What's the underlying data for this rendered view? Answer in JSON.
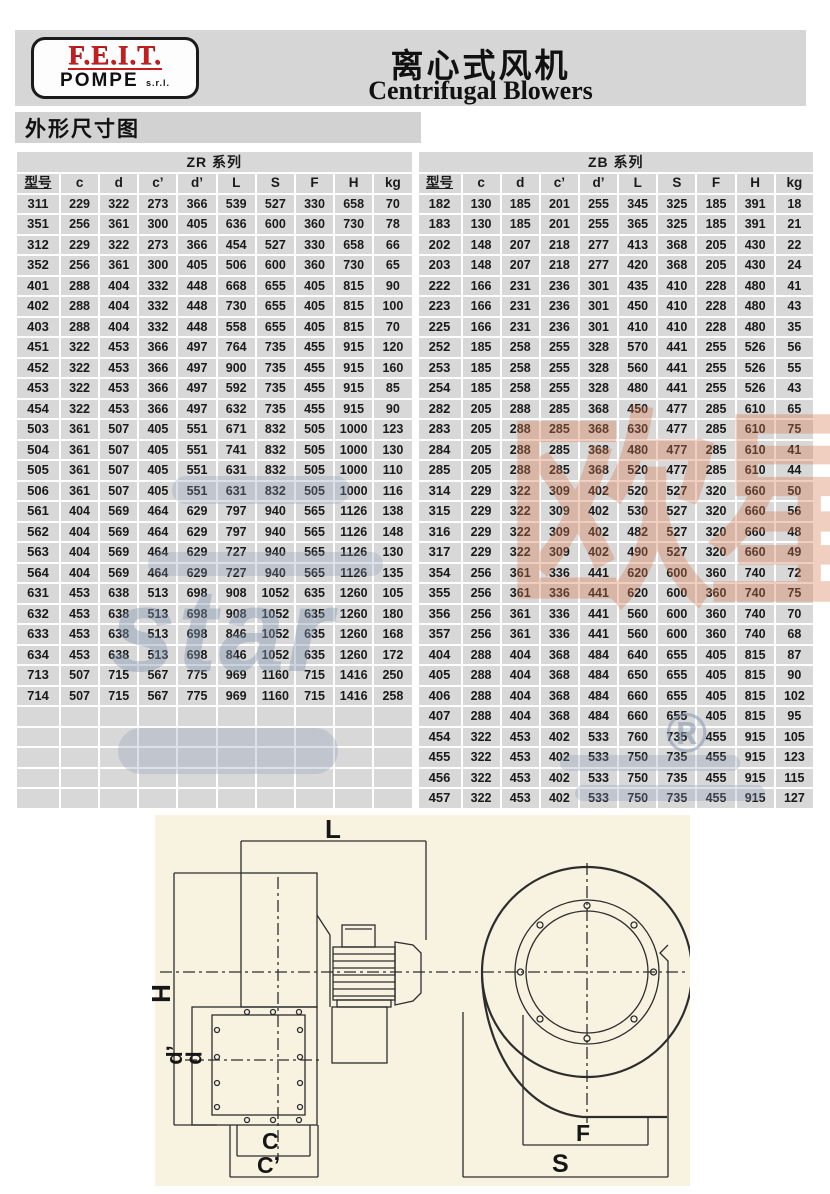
{
  "header": {
    "logo_line1": "F.E.I.T.",
    "logo_line2": "POMPE",
    "logo_suffix": "s.r.l.",
    "title_zh": "离心式风机",
    "title_en": "Centrifugal Blowers"
  },
  "section_label": "外形尺寸图",
  "tables": [
    {
      "title": "ZR 系列",
      "columns": [
        "型号",
        "c",
        "d",
        "c’",
        "d’",
        "L",
        "S",
        "F",
        "H",
        "kg"
      ],
      "rows": [
        [
          "311",
          229,
          322,
          273,
          366,
          539,
          527,
          330,
          658,
          70
        ],
        [
          "351",
          256,
          361,
          300,
          405,
          636,
          600,
          360,
          730,
          78
        ],
        [
          "312",
          229,
          322,
          273,
          366,
          454,
          527,
          330,
          658,
          66
        ],
        [
          "352",
          256,
          361,
          300,
          405,
          506,
          600,
          360,
          730,
          65
        ],
        [
          "401",
          288,
          404,
          332,
          448,
          668,
          655,
          405,
          815,
          90
        ],
        [
          "402",
          288,
          404,
          332,
          448,
          730,
          655,
          405,
          815,
          100
        ],
        [
          "403",
          288,
          404,
          332,
          448,
          558,
          655,
          405,
          815,
          70
        ],
        [
          "451",
          322,
          453,
          366,
          497,
          764,
          735,
          455,
          915,
          120
        ],
        [
          "452",
          322,
          453,
          366,
          497,
          900,
          735,
          455,
          915,
          160
        ],
        [
          "453",
          322,
          453,
          366,
          497,
          592,
          735,
          455,
          915,
          85
        ],
        [
          "454",
          322,
          453,
          366,
          497,
          632,
          735,
          455,
          915,
          90
        ],
        [
          "503",
          361,
          507,
          405,
          551,
          671,
          832,
          505,
          1000,
          123
        ],
        [
          "504",
          361,
          507,
          405,
          551,
          741,
          832,
          505,
          1000,
          130
        ],
        [
          "505",
          361,
          507,
          405,
          551,
          631,
          832,
          505,
          1000,
          110
        ],
        [
          "506",
          361,
          507,
          405,
          551,
          631,
          832,
          505,
          1000,
          116
        ],
        [
          "561",
          404,
          569,
          464,
          629,
          797,
          940,
          565,
          1126,
          138
        ],
        [
          "562",
          404,
          569,
          464,
          629,
          797,
          940,
          565,
          1126,
          148
        ],
        [
          "563",
          404,
          569,
          464,
          629,
          727,
          940,
          565,
          1126,
          130
        ],
        [
          "564",
          404,
          569,
          464,
          629,
          727,
          940,
          565,
          1126,
          135
        ],
        [
          "631",
          453,
          638,
          513,
          698,
          908,
          1052,
          635,
          1260,
          105
        ],
        [
          "632",
          453,
          638,
          513,
          698,
          908,
          1052,
          635,
          1260,
          180
        ],
        [
          "633",
          453,
          638,
          513,
          698,
          846,
          1052,
          635,
          1260,
          168
        ],
        [
          "634",
          453,
          638,
          513,
          698,
          846,
          1052,
          635,
          1260,
          172
        ],
        [
          "713",
          507,
          715,
          567,
          775,
          969,
          1160,
          715,
          1416,
          250
        ],
        [
          "714",
          507,
          715,
          567,
          775,
          969,
          1160,
          715,
          1416,
          258
        ],
        [
          "",
          "",
          "",
          "",
          "",
          "",
          "",
          "",
          "",
          ""
        ],
        [
          "",
          "",
          "",
          "",
          "",
          "",
          "",
          "",
          "",
          ""
        ],
        [
          "",
          "",
          "",
          "",
          "",
          "",
          "",
          "",
          "",
          ""
        ],
        [
          "",
          "",
          "",
          "",
          "",
          "",
          "",
          "",
          "",
          ""
        ],
        [
          "",
          "",
          "",
          "",
          "",
          "",
          "",
          "",
          "",
          ""
        ]
      ]
    },
    {
      "title": "ZB 系列",
      "columns": [
        "型号",
        "c",
        "d",
        "c’",
        "d’",
        "L",
        "S",
        "F",
        "H",
        "kg"
      ],
      "rows": [
        [
          "182",
          130,
          185,
          201,
          255,
          345,
          325,
          185,
          391,
          18
        ],
        [
          "183",
          130,
          185,
          201,
          255,
          365,
          325,
          185,
          391,
          21
        ],
        [
          "202",
          148,
          207,
          218,
          277,
          413,
          368,
          205,
          430,
          22
        ],
        [
          "203",
          148,
          207,
          218,
          277,
          420,
          368,
          205,
          430,
          24
        ],
        [
          "222",
          166,
          231,
          236,
          301,
          435,
          410,
          228,
          480,
          41
        ],
        [
          "223",
          166,
          231,
          236,
          301,
          450,
          410,
          228,
          480,
          43
        ],
        [
          "225",
          166,
          231,
          236,
          301,
          410,
          410,
          228,
          480,
          35
        ],
        [
          "252",
          185,
          258,
          255,
          328,
          570,
          441,
          255,
          526,
          56
        ],
        [
          "253",
          185,
          258,
          255,
          328,
          560,
          441,
          255,
          526,
          55
        ],
        [
          "254",
          185,
          258,
          255,
          328,
          480,
          441,
          255,
          526,
          43
        ],
        [
          "282",
          205,
          288,
          285,
          368,
          450,
          477,
          285,
          610,
          65
        ],
        [
          "283",
          205,
          288,
          285,
          368,
          630,
          477,
          285,
          610,
          75
        ],
        [
          "284",
          205,
          288,
          285,
          368,
          480,
          477,
          285,
          610,
          41
        ],
        [
          "285",
          205,
          288,
          285,
          368,
          520,
          477,
          285,
          610,
          44
        ],
        [
          "314",
          229,
          322,
          309,
          402,
          520,
          527,
          320,
          660,
          50
        ],
        [
          "315",
          229,
          322,
          309,
          402,
          530,
          527,
          320,
          660,
          56
        ],
        [
          "316",
          229,
          322,
          309,
          402,
          482,
          527,
          320,
          660,
          48
        ],
        [
          "317",
          229,
          322,
          309,
          402,
          490,
          527,
          320,
          660,
          49
        ],
        [
          "354",
          256,
          361,
          336,
          441,
          620,
          600,
          360,
          740,
          72
        ],
        [
          "355",
          256,
          361,
          336,
          441,
          620,
          600,
          360,
          740,
          75
        ],
        [
          "356",
          256,
          361,
          336,
          441,
          560,
          600,
          360,
          740,
          70
        ],
        [
          "357",
          256,
          361,
          336,
          441,
          560,
          600,
          360,
          740,
          68
        ],
        [
          "404",
          288,
          404,
          368,
          484,
          640,
          655,
          405,
          815,
          87
        ],
        [
          "405",
          288,
          404,
          368,
          484,
          650,
          655,
          405,
          815,
          90
        ],
        [
          "406",
          288,
          404,
          368,
          484,
          660,
          655,
          405,
          815,
          102
        ],
        [
          "407",
          288,
          404,
          368,
          484,
          660,
          655,
          405,
          815,
          95
        ],
        [
          "454",
          322,
          453,
          402,
          533,
          760,
          735,
          455,
          915,
          105
        ],
        [
          "455",
          322,
          453,
          402,
          533,
          750,
          735,
          455,
          915,
          123
        ],
        [
          "456",
          322,
          453,
          402,
          533,
          750,
          735,
          455,
          915,
          115
        ],
        [
          "457",
          322,
          453,
          402,
          533,
          750,
          735,
          455,
          915,
          127
        ]
      ]
    }
  ],
  "diagram": {
    "length_label": "L",
    "height_label": "H",
    "d_prime_label": "d’",
    "d_label": "d",
    "c_label": "C",
    "c_prime_label": "C’",
    "f_label": "F",
    "s_label": "S"
  },
  "watermark": {
    "text_cn": "欧星",
    "text_star": "star",
    "registered": "®"
  },
  "colors": {
    "band_gray": "#d6d6d6",
    "cell_gray": "#d8d8d8",
    "logo_red": "#c41e1e",
    "drawing_cream": "#f8f3e1",
    "watermark_orange": "#d67a50",
    "watermark_blue": "#8496b0"
  }
}
